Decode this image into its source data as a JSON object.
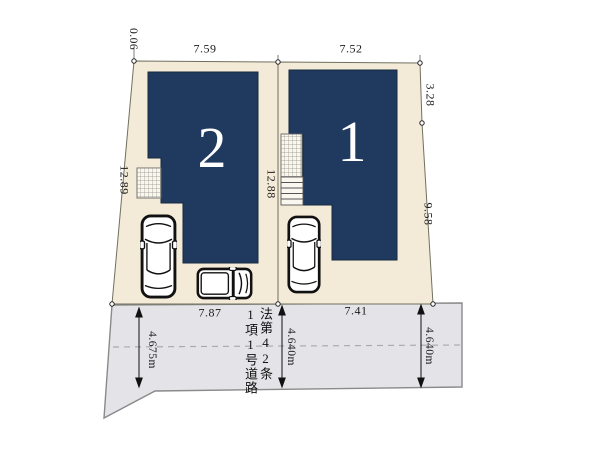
{
  "plan": {
    "type": "real-estate-site-plan",
    "buildings": [
      {
        "number": "1"
      },
      {
        "number": "2"
      }
    ],
    "dims": {
      "corner_jog": "0.06",
      "lot2_top_width": "7.59",
      "lot1_top_width": "7.52",
      "lot1_right_upper": "3.28",
      "lot2_left_depth": "12.89",
      "divider_depth": "12.88",
      "lot1_right_lower": "9.58",
      "lot2_frontage": "7.87",
      "lot1_frontage": "7.41",
      "road_width_left": "4.675m",
      "road_width_middle": "4.640m",
      "road_width_right": "4.640m"
    },
    "road": {
      "designation": "法第42条\n1項1号道路"
    },
    "colors": {
      "lot_fill": "#f3ead7",
      "building_fill": "#1f3a5e",
      "road_fill": "#e4e4e8",
      "hatch_fill": "#faf7ee"
    }
  }
}
